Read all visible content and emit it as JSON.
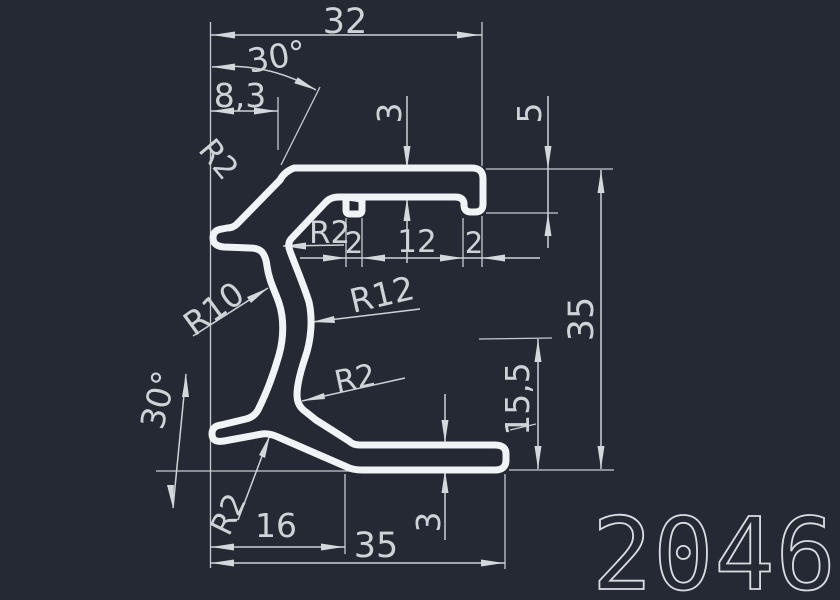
{
  "title": {
    "profile_number": "2046"
  },
  "dimensions": {
    "width_top": "32",
    "angle_top": "30°",
    "offset_top": "8,3",
    "thickness_top": "3",
    "lip_depth": "5",
    "groove_width_left": "2",
    "groove_spacing": "12",
    "lip_width": "2",
    "height_overall": "35",
    "height_inner": "15,5",
    "angle_bottom": "30°",
    "offset_bottom": "16",
    "width_bottom": "35",
    "thickness_bottom": "3"
  },
  "radius_labels": {
    "fillet_top_left": "R2",
    "fillet_inner_top": "R2",
    "radius_outer_wall": "R10",
    "radius_inner_wall": "R12",
    "fillet_mid": "R2",
    "fillet_bottom": "R2"
  },
  "colors": {
    "background": "#242933",
    "profile_line": "#f1f4f6",
    "dimension_line": "#cdd2d7",
    "text": "#ced3d8"
  }
}
